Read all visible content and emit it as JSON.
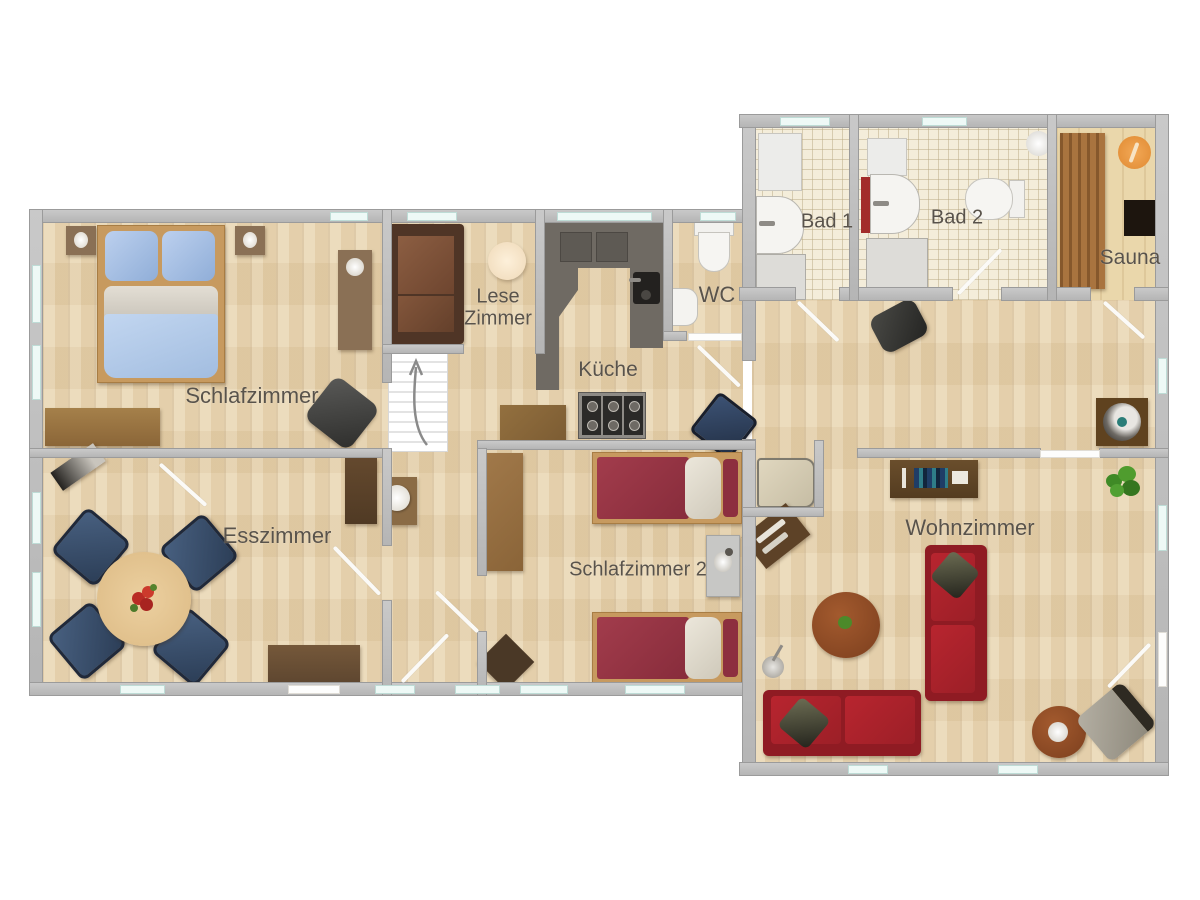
{
  "plan_title": "Grundriss / floor plan",
  "rooms": {
    "schlafzimmer": {
      "label": "Schlafzimmer"
    },
    "lesezimmer": {
      "line1": "Lese",
      "line2": "Zimmer"
    },
    "kueche": {
      "label": "Küche"
    },
    "wc": {
      "label": "WC"
    },
    "bad1": {
      "label": "Bad 1"
    },
    "bad2": {
      "label": "Bad 2"
    },
    "sauna": {
      "label": "Sauna"
    },
    "esszimmer": {
      "label": "Esszimmer"
    },
    "schlafzimmer2": {
      "label": "Schlafzimmer 2"
    },
    "wohnzimmer": {
      "label": "Wohnzimmer"
    }
  },
  "colors": {
    "wall": "#bfbfbf",
    "floor_wood": "#e9d6b2",
    "floor_tile": "#f4edda",
    "window": "#eef9f6",
    "label_text": "#59534b",
    "sofa_red": "#a8212b",
    "bed_blue": "#aecbea",
    "bed_red": "#993646",
    "chair_blue": "#3b5068",
    "reading_sofa_brown": "#7b5138",
    "furniture_brown": "#8a6b45",
    "sauna_wood": "#a9743f",
    "sauna_light_orange": "#e8923e",
    "counter_gray": "#6f6a63"
  }
}
